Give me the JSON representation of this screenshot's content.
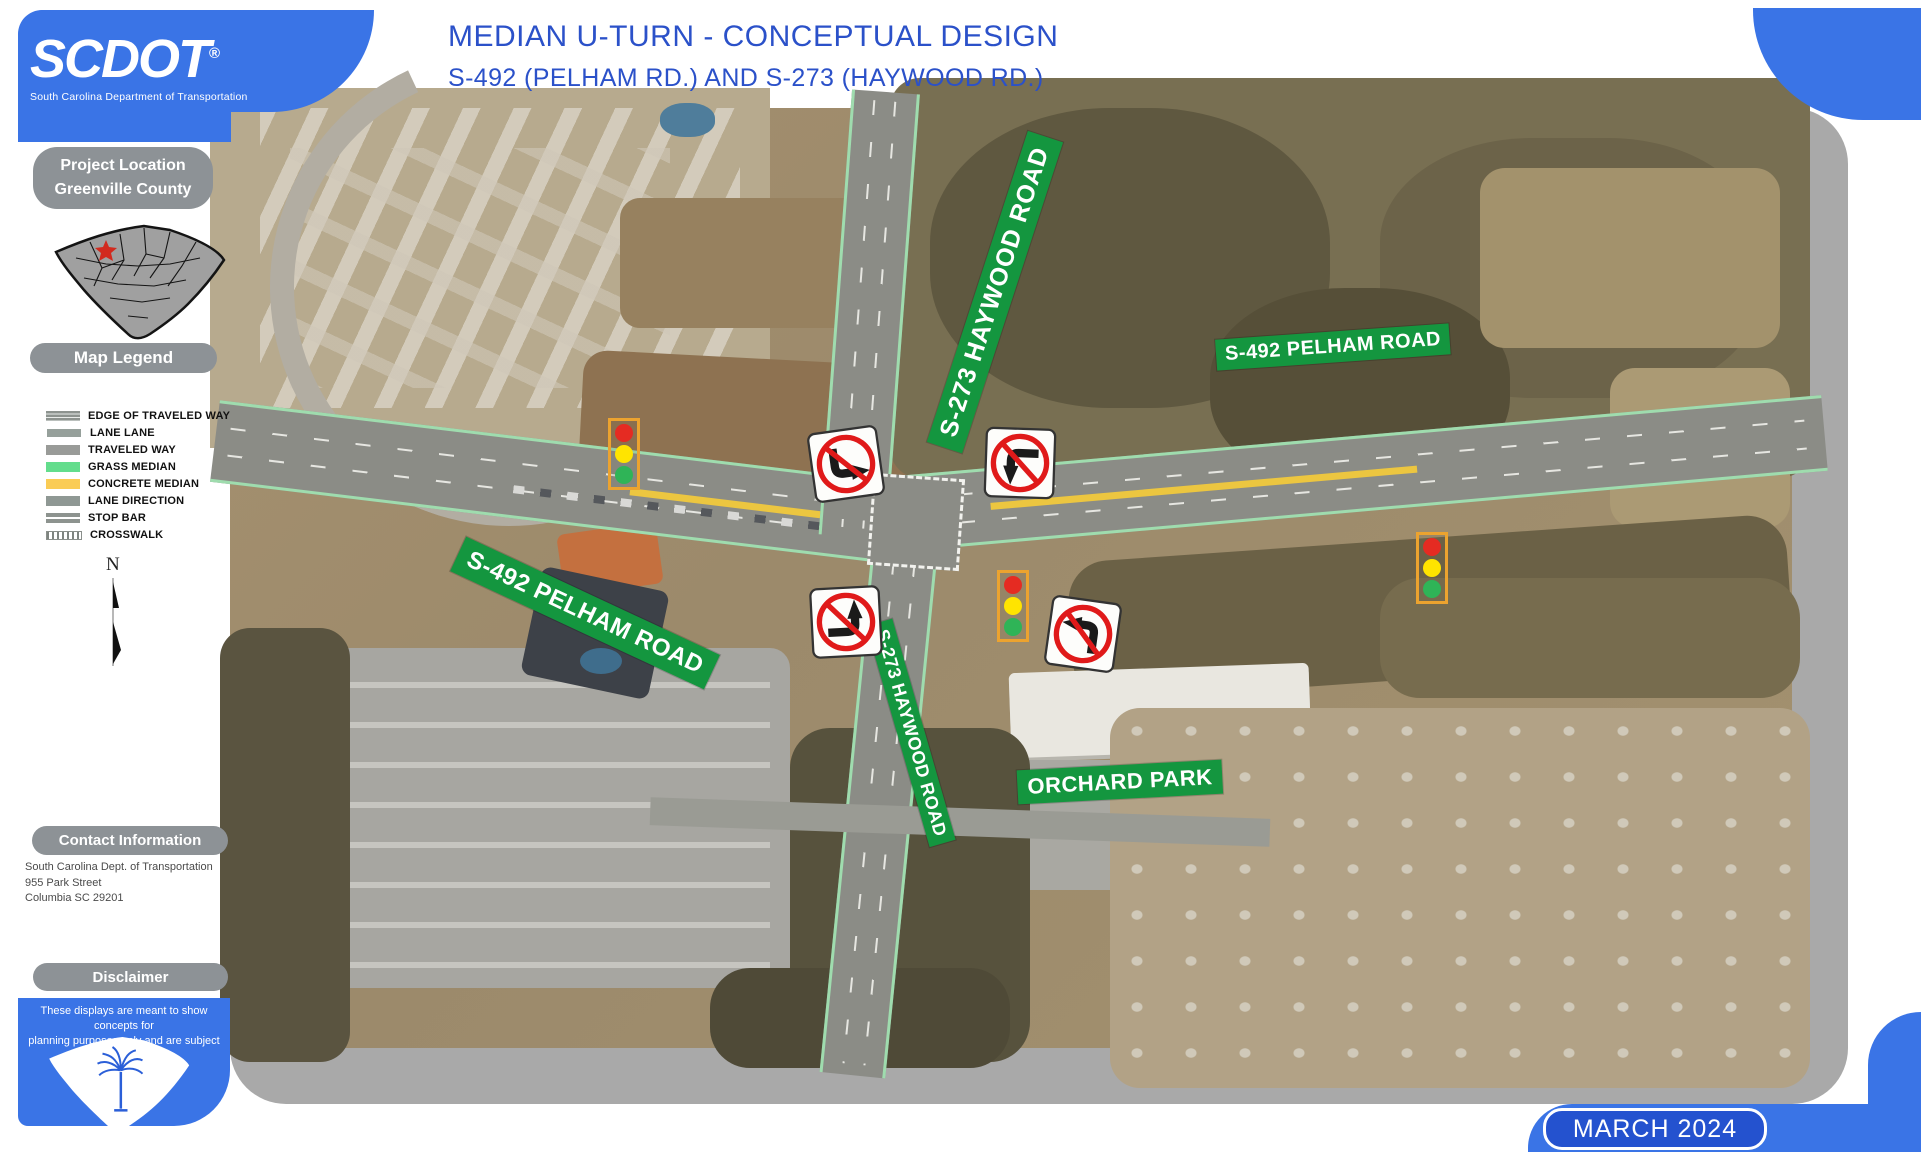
{
  "header": {
    "logo": {
      "brand": "SCDOT",
      "registered": "®",
      "tagline": "South Carolina Department of Transportation"
    },
    "title": "MEDIAN U-TURN - CONCEPTUAL DESIGN",
    "subtitle": "S-492 (PELHAM RD.) AND S-273 (HAYWOOD RD.)"
  },
  "sidebar": {
    "project_location": {
      "line1": "Project Location",
      "line2": "Greenville County"
    },
    "legend": {
      "heading": "Map Legend",
      "items": [
        {
          "label": "EDGE OF TRAVELED WAY"
        },
        {
          "label": "LANE LANE"
        },
        {
          "label": "TRAVELED WAY"
        },
        {
          "label": "GRASS MEDIAN"
        },
        {
          "label": "CONCRETE MEDIAN"
        },
        {
          "label": "LANE DIRECTION"
        },
        {
          "label": "STOP BAR"
        },
        {
          "label": "CROSSWALK"
        }
      ]
    },
    "north_label": "N",
    "contact": {
      "heading": "Contact Information",
      "lines": [
        "South Carolina Dept. of Transportation",
        "955 Park Street",
        "Columbia SC 29201"
      ]
    },
    "disclaimer": {
      "heading": "Disclaimer",
      "line1": "These displays are meant to show concepts for",
      "line2": "planning purposes only and are subject to change."
    }
  },
  "map": {
    "labels": {
      "haywood_north": "S-273 HAYWOOD ROAD",
      "pelham_east": "S-492 PELHAM ROAD",
      "pelham_west": "S-492 PELHAM ROAD",
      "haywood_south": "S-273 HAYWOOD ROAD",
      "orchard_park": "ORCHARD PARK"
    },
    "signs": [
      {
        "name": "turn-prohibition-sign-northwest"
      },
      {
        "name": "turn-prohibition-sign-northeast"
      },
      {
        "name": "turn-prohibition-sign-southwest"
      },
      {
        "name": "turn-prohibition-sign-southeast"
      }
    ],
    "signals": [
      {
        "name": "traffic-signal-west"
      },
      {
        "name": "traffic-signal-south"
      },
      {
        "name": "traffic-signal-east"
      }
    ],
    "signal_colors": {
      "red": "#e52b22",
      "yellow": "#ffe400",
      "green": "#2fb457"
    }
  },
  "footer": {
    "date": "MARCH 2024"
  },
  "colors": {
    "frame_blue": "#3a74e6",
    "title_blue": "#2b51c9",
    "pill_gray": "#8d9296",
    "banner_green": "#14963f",
    "map_border_gray": "#a9a9a9",
    "grass_median": "#63dd8c",
    "concrete_median": "#facc55",
    "signal_box_orange": "#eca32f"
  }
}
